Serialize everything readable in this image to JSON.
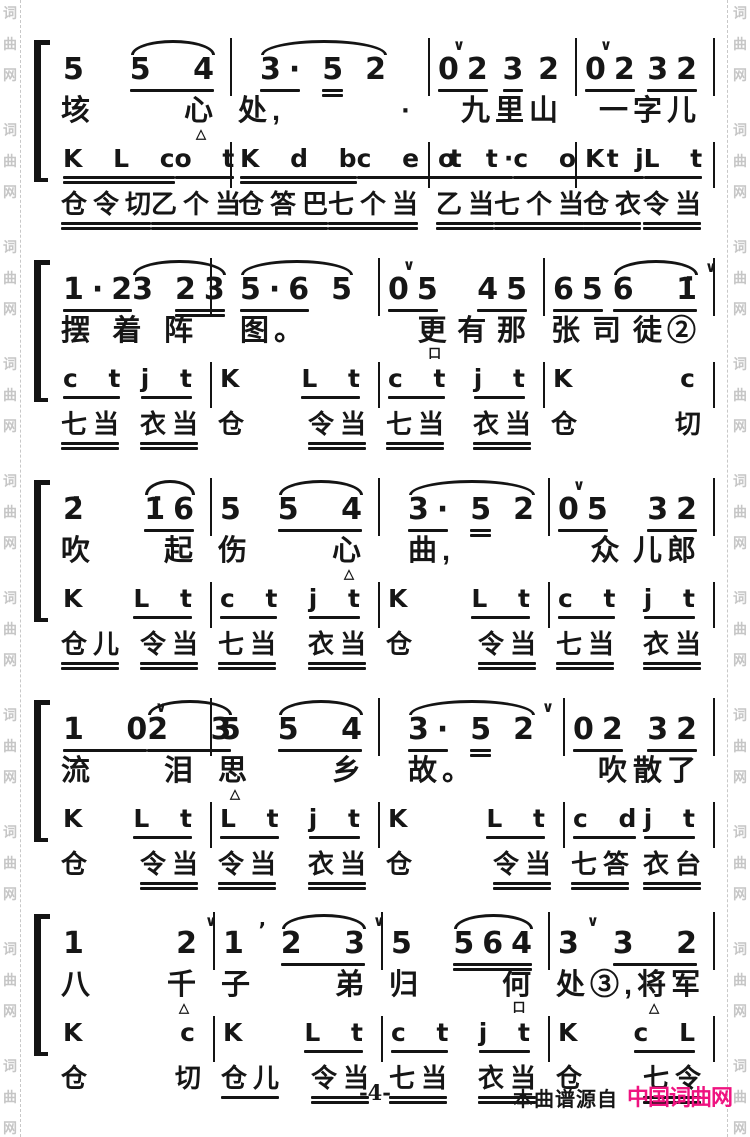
{
  "page": {
    "number": "-4-",
    "source_label": "本曲谱源自",
    "brand": "中国词曲网",
    "brand_color": "#ef1380",
    "ink_color": "#161616",
    "watermark": {
      "text": "词曲网",
      "color": "#c6c6c6"
    }
  },
  "score": {
    "systems": [
      {
        "top": 38,
        "weights": [
          177,
          198,
          147,
          138
        ],
        "melody": [
          [
            {
              "t": "5",
              "u": 0
            },
            {
              "tie": true,
              "blocks": [
                {
                  "t": "5 4",
                  "u": 1
                }
              ]
            }
          ],
          [
            {
              "tie": true,
              "blocks": [
                {
                  "t": "3·",
                  "u": 1
                },
                {
                  "t": "5",
                  "u": 2
                },
                {
                  "t": "2",
                  "u": 0
                }
              ]
            }
          ],
          [
            {
              "t": "02",
              "u": 1,
              "v": true
            },
            {
              "t": "3",
              "u": 1
            },
            {
              "t": "2",
              "u": 0
            }
          ],
          [
            {
              "t": "02",
              "u": 1,
              "v": true
            },
            {
              "t": "32",
              "u": 1
            }
          ]
        ],
        "lyrics": [
          [
            {
              "t": "垓"
            },
            {
              "t": "心",
              "mk": "△"
            }
          ],
          [
            {
              "t": "处,"
            },
            {
              "t": "·"
            }
          ],
          [
            {
              "t": ""
            },
            {
              "t": "九"
            },
            {
              "t": "里"
            },
            {
              "t": "山"
            }
          ],
          [
            {
              "t": ""
            },
            {
              "t": "一"
            },
            {
              "t": "字"
            },
            {
              "t": "儿"
            }
          ]
        ],
        "perc": [
          [
            {
              "t": "K L c",
              "u": 2
            },
            {
              "t": "o t",
              "u": 1
            }
          ],
          [
            {
              "t": "K d b",
              "u": 2
            },
            {
              "t": "c e t",
              "u": 1
            }
          ],
          [
            {
              "t": "o t·",
              "u": 1
            },
            {
              "t": "c o t",
              "u": 1
            }
          ],
          [
            {
              "t": "K j",
              "u": 1
            },
            {
              "t": "L t",
              "u": 1
            }
          ]
        ],
        "syll": [
          [
            {
              "t": "仓令切",
              "u": 2
            },
            {
              "t": "乙个当",
              "u": 2
            }
          ],
          [
            {
              "t": "仓答巴",
              "u": 2
            },
            {
              "t": "七个当",
              "u": 2
            }
          ],
          [
            {
              "t": "乙当",
              "u": 2
            },
            {
              "t": "七个当",
              "u": 2
            }
          ],
          [
            {
              "t": "仓衣",
              "u": 2
            },
            {
              "t": "令当",
              "u": 2
            }
          ]
        ]
      },
      {
        "top": 258,
        "weights": [
          157,
          168,
          165,
          170
        ],
        "melody": [
          [
            {
              "t": "1·2",
              "u": 1
            },
            {
              "tie": true,
              "blocks": [
                {
                  "t": "3",
                  "u": 0
                },
                {
                  "t": "23",
                  "u": 2
                }
              ]
            }
          ],
          [
            {
              "tie": true,
              "blocks": [
                {
                  "t": "5·6",
                  "u": 1
                },
                {
                  "t": "5",
                  "u": 0
                }
              ]
            }
          ],
          [
            {
              "t": "05",
              "u": 1,
              "v": true
            },
            {
              "t": "45",
              "u": 1
            }
          ],
          [
            {
              "t": "65",
              "u": 1
            },
            {
              "tie": true,
              "blocks": [
                {
                  "t": "6 1̇",
                  "u": 1,
                  "va": true
                }
              ]
            }
          ]
        ],
        "lyrics": [
          [
            {
              "t": "摆"
            },
            {
              "t": "着"
            },
            {
              "t": "阵"
            }
          ],
          [
            {
              "t": "图。"
            }
          ],
          [
            {
              "t": ""
            },
            {
              "t": "更",
              "mk": "口"
            },
            {
              "t": "有"
            },
            {
              "t": "那"
            }
          ],
          [
            {
              "t": "张"
            },
            {
              "t": "司"
            },
            {
              "t": "徒②"
            }
          ]
        ],
        "perc": [
          [
            {
              "t": "c t",
              "u": 1
            },
            {
              "t": "j t",
              "u": 1
            }
          ],
          [
            {
              "t": "K",
              "u": 0
            },
            {
              "t": "L t",
              "u": 1
            }
          ],
          [
            {
              "t": "c t",
              "u": 1
            },
            {
              "t": "j t",
              "u": 1
            }
          ],
          [
            {
              "t": "K",
              "u": 0
            },
            {
              "t": "c",
              "u": 0
            }
          ]
        ],
        "syll": [
          [
            {
              "t": "七当",
              "u": 2
            },
            {
              "t": "衣当",
              "u": 2
            }
          ],
          [
            {
              "t": "仓",
              "u": 0
            },
            {
              "t": "令当",
              "u": 2
            }
          ],
          [
            {
              "t": "七当",
              "u": 2
            },
            {
              "t": "衣当",
              "u": 2
            }
          ],
          [
            {
              "t": "仓",
              "u": 0
            },
            {
              "t": "切",
              "u": 0
            }
          ]
        ]
      },
      {
        "top": 478,
        "weights": [
          157,
          168,
          170,
          165
        ],
        "melody": [
          [
            {
              "t": "2̇",
              "u": 0
            },
            {
              "tie": true,
              "blocks": [
                {
                  "t": "1̇6",
                  "u": 1
                }
              ]
            }
          ],
          [
            {
              "t": "5",
              "u": 0
            },
            {
              "tie": true,
              "blocks": [
                {
                  "t": "5 4",
                  "u": 1
                }
              ]
            }
          ],
          [
            {
              "tie": true,
              "blocks": [
                {
                  "t": "3·",
                  "u": 1
                },
                {
                  "t": "5",
                  "u": 2
                },
                {
                  "t": "2",
                  "u": 0
                }
              ]
            }
          ],
          [
            {
              "t": "05",
              "u": 1,
              "v": true
            },
            {
              "t": "32",
              "u": 1
            }
          ]
        ],
        "lyrics": [
          [
            {
              "t": "吹"
            },
            {
              "t": "起"
            }
          ],
          [
            {
              "t": "伤"
            },
            {
              "t": "心",
              "mk": "△"
            }
          ],
          [
            {
              "t": "曲,"
            }
          ],
          [
            {
              "t": ""
            },
            {
              "t": "众"
            },
            {
              "t": "儿郎"
            }
          ]
        ],
        "perc": [
          [
            {
              "t": "K",
              "u": 0
            },
            {
              "t": "L t",
              "u": 1
            }
          ],
          [
            {
              "t": "c t",
              "u": 1
            },
            {
              "t": "j t",
              "u": 1
            }
          ],
          [
            {
              "t": "K",
              "u": 0
            },
            {
              "t": "L t",
              "u": 1
            }
          ],
          [
            {
              "t": "c t",
              "u": 1
            },
            {
              "t": "j t",
              "u": 1
            }
          ]
        ],
        "syll": [
          [
            {
              "t": "仓儿",
              "u": 2
            },
            {
              "t": "令当",
              "u": 2
            }
          ],
          [
            {
              "t": "七当",
              "u": 2
            },
            {
              "t": "衣当",
              "u": 2
            }
          ],
          [
            {
              "t": "仓",
              "u": 0
            },
            {
              "t": "令当",
              "u": 2
            }
          ],
          [
            {
              "t": "七当",
              "u": 2
            },
            {
              "t": "衣当",
              "u": 2
            }
          ]
        ]
      },
      {
        "top": 698,
        "weights": [
          157,
          168,
          185,
          150
        ],
        "melody": [
          [
            {
              "t": "1 0",
              "u": 1,
              "va": true
            },
            {
              "tie": true,
              "blocks": [
                {
                  "t": "2 3",
                  "u": 1
                }
              ]
            }
          ],
          [
            {
              "t": "5",
              "u": 0
            },
            {
              "tie": true,
              "blocks": [
                {
                  "t": "5 4",
                  "u": 1
                }
              ]
            }
          ],
          [
            {
              "tie": true,
              "blocks": [
                {
                  "t": "3·",
                  "u": 1
                },
                {
                  "t": "5",
                  "u": 2
                },
                {
                  "t": "2",
                  "u": 0,
                  "va": true
                }
              ]
            }
          ],
          [
            {
              "t": "02",
              "u": 1
            },
            {
              "t": "32",
              "u": 1
            }
          ]
        ],
        "lyrics": [
          [
            {
              "t": "流"
            },
            {
              "t": "泪"
            }
          ],
          [
            {
              "t": "思",
              "mk": "△"
            },
            {
              "t": "乡"
            }
          ],
          [
            {
              "t": "故。"
            }
          ],
          [
            {
              "t": ""
            },
            {
              "t": "吹"
            },
            {
              "t": "散了"
            }
          ]
        ],
        "perc": [
          [
            {
              "t": "K",
              "u": 0
            },
            {
              "t": "L t",
              "u": 1
            }
          ],
          [
            {
              "t": "L t",
              "u": 1
            },
            {
              "t": "j t",
              "u": 1
            }
          ],
          [
            {
              "t": "K",
              "u": 0
            },
            {
              "t": "L t",
              "u": 1
            }
          ],
          [
            {
              "t": "c d",
              "u": 1
            },
            {
              "t": "j t",
              "u": 1
            }
          ]
        ],
        "syll": [
          [
            {
              "t": "仓",
              "u": 0
            },
            {
              "t": "令当",
              "u": 2
            }
          ],
          [
            {
              "t": "令当",
              "u": 2
            },
            {
              "t": "衣当",
              "u": 2
            }
          ],
          [
            {
              "t": "仓",
              "u": 0
            },
            {
              "t": "令当",
              "u": 2
            }
          ],
          [
            {
              "t": "七答",
              "u": 2
            },
            {
              "t": "衣台",
              "u": 2
            }
          ]
        ]
      },
      {
        "top": 912,
        "weights": [
          160,
          168,
          167,
          165
        ],
        "melody": [
          [
            {
              "t": "1",
              "u": 0
            },
            {
              "t": "2",
              "u": 0,
              "va": true
            }
          ],
          [
            {
              "t": "1",
              "u": 0
            },
            {
              "t": "’",
              "u": 0,
              "sm": true
            },
            {
              "tie": true,
              "blocks": [
                {
                  "t": "2 3",
                  "u": 1,
                  "va": true
                }
              ]
            }
          ],
          [
            {
              "t": "5",
              "u": 0
            },
            {
              "tie": true,
              "blocks": [
                {
                  "t": "564",
                  "u": 2
                }
              ]
            }
          ],
          [
            {
              "t": "3",
              "u": 0,
              "va": true
            },
            {
              "t": "3 2",
              "u": 1
            }
          ]
        ],
        "lyrics": [
          [
            {
              "t": "八"
            },
            {
              "t": "千",
              "mk": "△"
            }
          ],
          [
            {
              "t": "子"
            },
            {
              "t": "弟"
            }
          ],
          [
            {
              "t": "归"
            },
            {
              "t": "何",
              "mk": "口"
            }
          ],
          [
            {
              "t": "处③,"
            },
            {
              "t": "将",
              "mk": "△"
            },
            {
              "t": "军"
            }
          ]
        ],
        "perc": [
          [
            {
              "t": "K",
              "u": 0
            },
            {
              "t": "c",
              "u": 0
            }
          ],
          [
            {
              "t": "K",
              "u": 0
            },
            {
              "t": "L t",
              "u": 1
            }
          ],
          [
            {
              "t": "c t",
              "u": 1
            },
            {
              "t": "j t",
              "u": 1
            }
          ],
          [
            {
              "t": "K",
              "u": 0
            },
            {
              "t": "c L",
              "u": 1
            }
          ]
        ],
        "syll": [
          [
            {
              "t": "仓",
              "u": 0
            },
            {
              "t": "切",
              "u": 0
            }
          ],
          [
            {
              "t": "仓儿",
              "u": 1
            },
            {
              "t": "令当",
              "u": 2
            }
          ],
          [
            {
              "t": "七当",
              "u": 2
            },
            {
              "t": "衣当",
              "u": 2
            }
          ],
          [
            {
              "t": "仓",
              "u": 0
            },
            {
              "t": "七令",
              "u": 2
            }
          ]
        ]
      }
    ]
  }
}
